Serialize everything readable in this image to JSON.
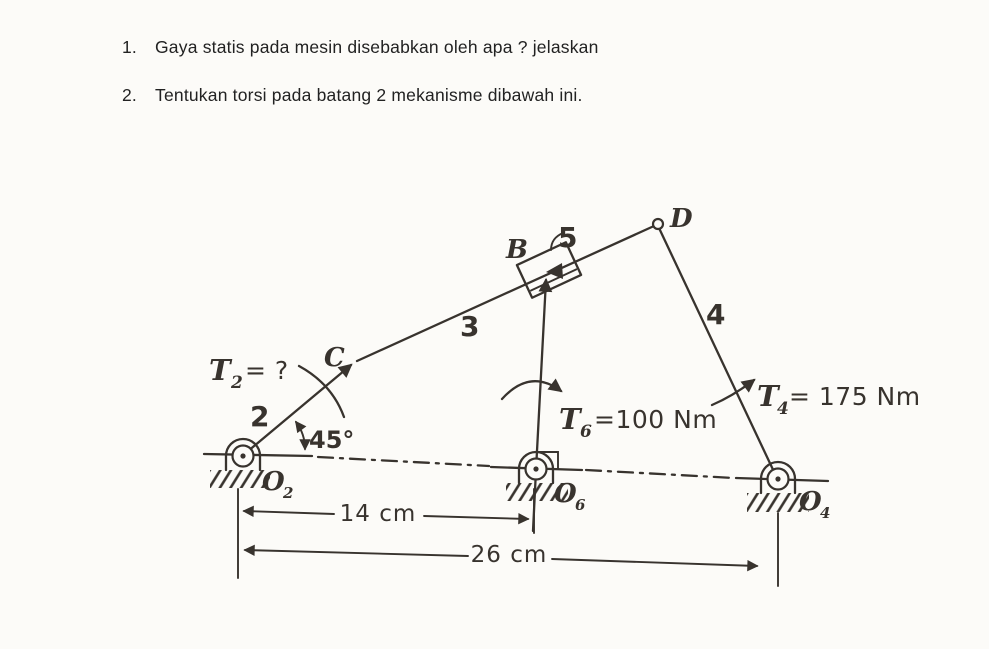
{
  "questions": [
    {
      "number": "1.",
      "text": "Gaya statis pada mesin disebabkan oleh apa ? jelaskan"
    },
    {
      "number": "2.",
      "text": "Tentukan torsi pada batang 2 mekanisme dibawah ini."
    }
  ],
  "diagram": {
    "torques": {
      "t2": {
        "symbol": "T",
        "sub": "2",
        "value": "= ?"
      },
      "t6": {
        "symbol": "T",
        "sub": "6",
        "value": "=100 Nm"
      },
      "t4": {
        "symbol": "T",
        "sub": "4",
        "value": "= 175 Nm"
      }
    },
    "pivots": {
      "o2": {
        "symbol": "O",
        "sub": "2"
      },
      "o6": {
        "symbol": "O",
        "sub": "6"
      },
      "o4": {
        "symbol": "O",
        "sub": "4"
      }
    },
    "points": {
      "b": "B",
      "c": "C",
      "d": "D"
    },
    "links": {
      "link2": "2",
      "link3": "3",
      "link4": "4",
      "link5": "5"
    },
    "angle": {
      "value": "45°"
    },
    "dimensions": {
      "o2_o6": "14 cm",
      "o2_o4": "26 cm"
    },
    "colors": {
      "ink": "#38332e",
      "paper": "#fcfbf8"
    }
  }
}
